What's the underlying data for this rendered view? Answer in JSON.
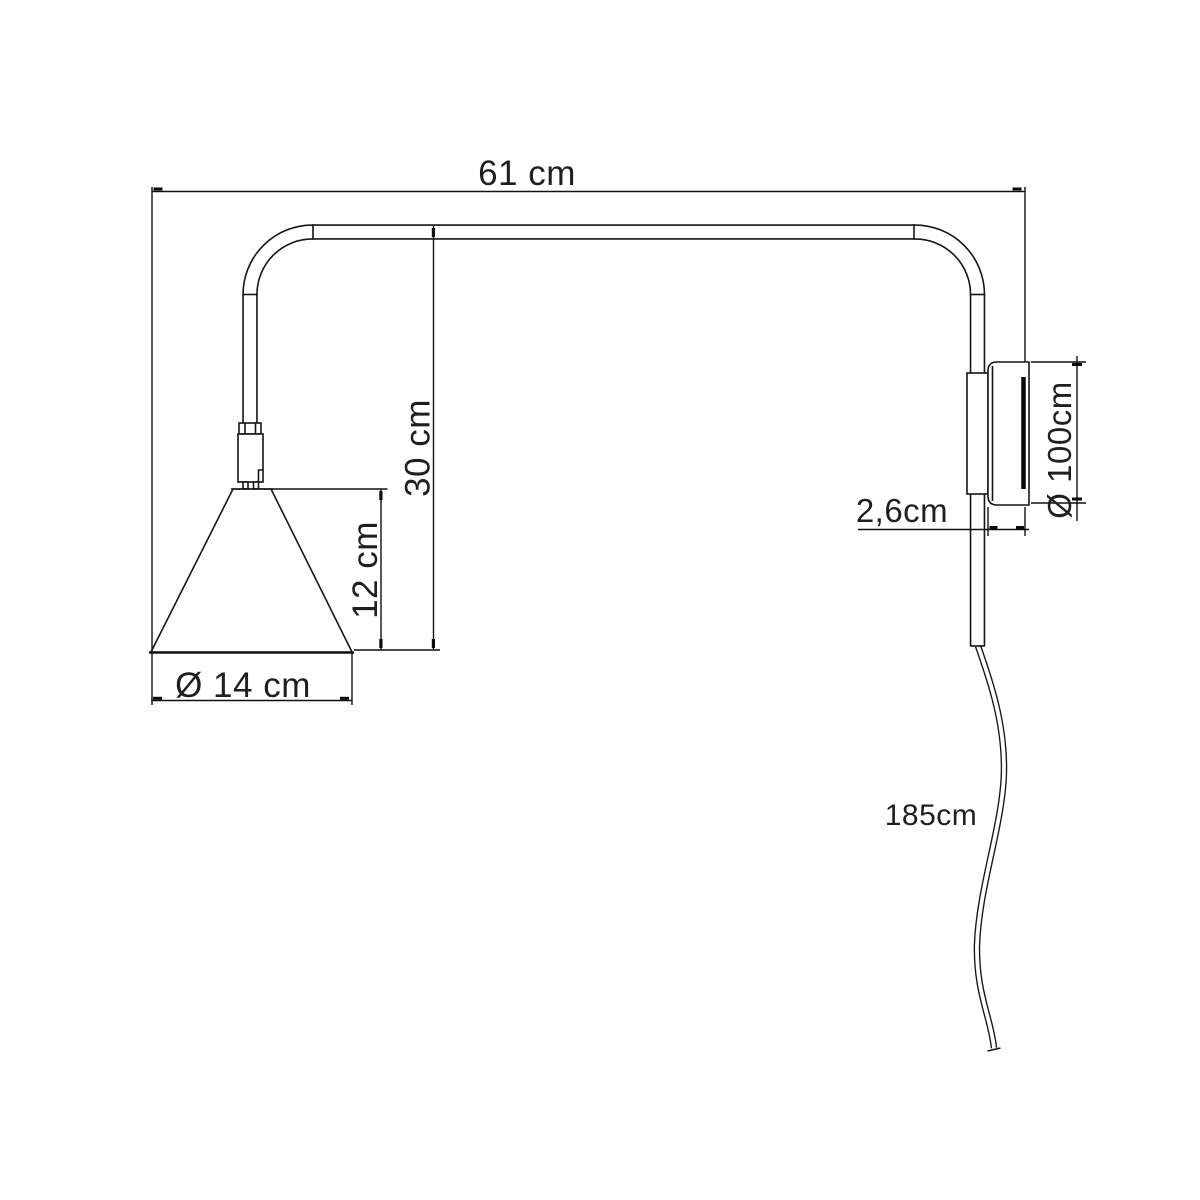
{
  "colors": {
    "background": "#ffffff",
    "line": "#151515",
    "text": "#1f1f1f"
  },
  "dimensions": {
    "arm_width": "61 cm",
    "arm_drop": "30 cm",
    "shade_height": "12 cm",
    "shade_diameter": "Ø 14 cm",
    "wall_plate_depth": "2,6cm",
    "wall_plate_diameter": "Ø 100cm",
    "cable_length": "185cm"
  }
}
